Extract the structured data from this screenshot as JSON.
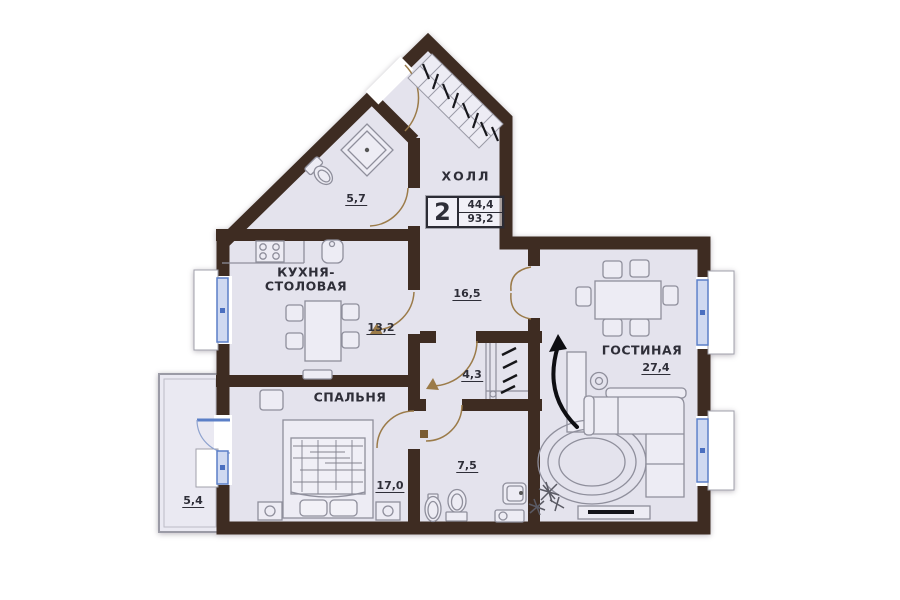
{
  "apartment_card": {
    "room_count": "2",
    "living_area": "44,4",
    "total_area": "93,2"
  },
  "labels": {
    "hall": {
      "name": "ХОЛЛ",
      "area": "16,5"
    },
    "shower_room": {
      "area": "5,7"
    },
    "kitchen": {
      "name_line1": "КУХНЯ-",
      "name_line2": "СТОЛОВАЯ",
      "area": "13,2"
    },
    "bedroom": {
      "name": "СПАЛЬНЯ",
      "area": "17,0"
    },
    "corridor": {
      "area": "4,3"
    },
    "bathroom": {
      "area": "7,5"
    },
    "living_room": {
      "name": "ГОСТИНАЯ",
      "area": "27,4"
    },
    "balcony": {
      "area": "5,4"
    }
  },
  "colors": {
    "wall": "#3e2c22",
    "floor": "#e4e3ed",
    "furniture_line": "#8f8f9c",
    "window_frame": "#5b7fc7",
    "window_fill": "#cfd9f1",
    "door_arc": "#9b7b49",
    "text": "#2e2e38"
  }
}
